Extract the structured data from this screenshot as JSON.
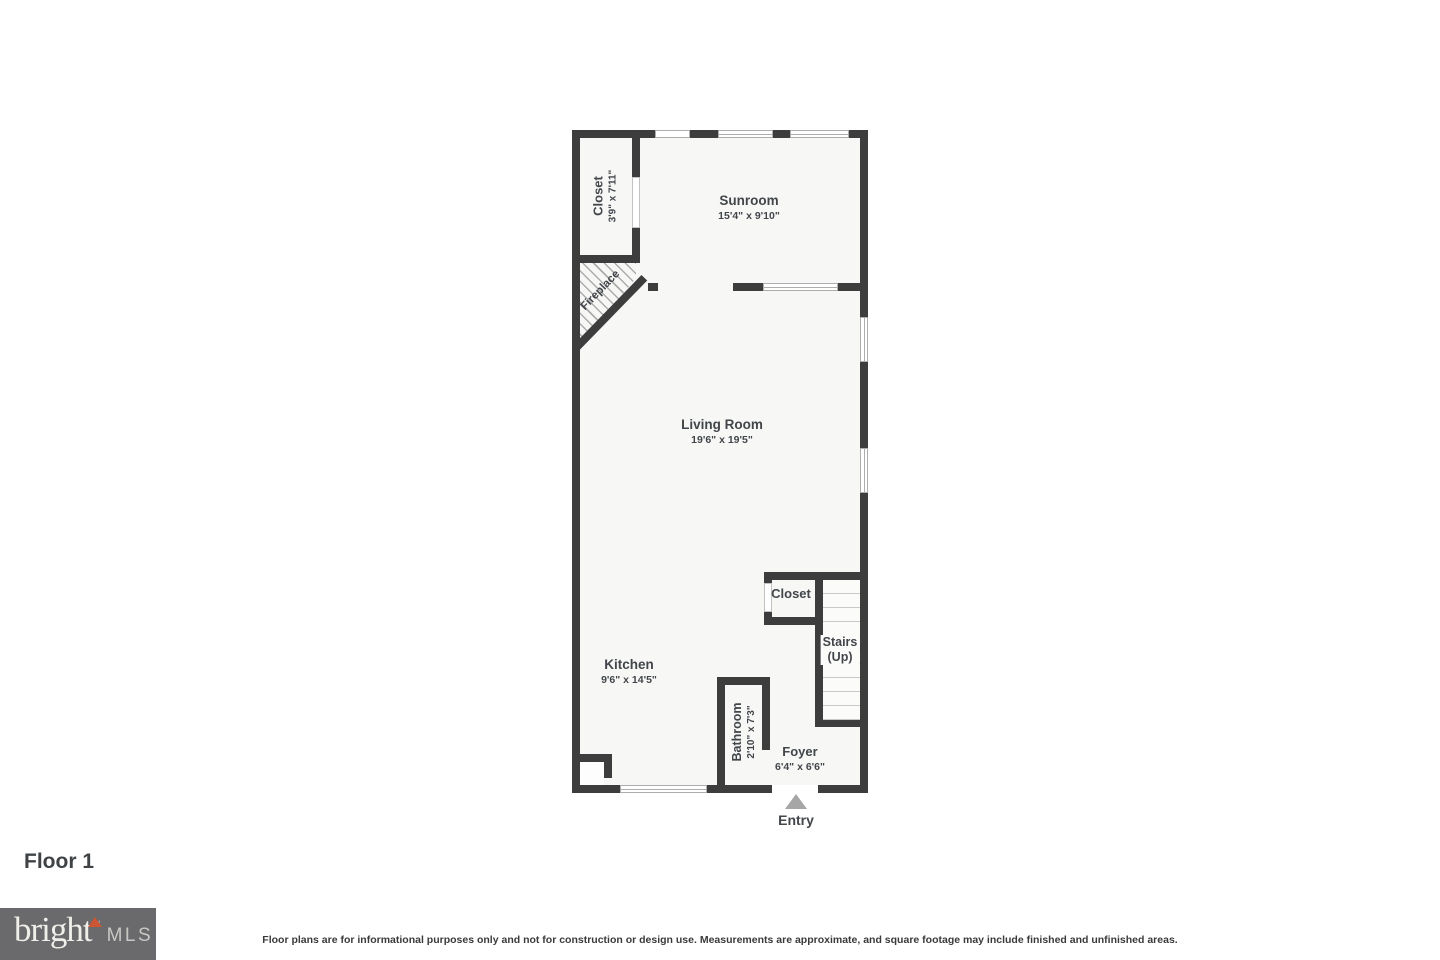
{
  "page": {
    "floor_label": "Floor 1",
    "disclaimer": "Floor plans are for informational purposes only and not for construction or design use. Measurements are approximate, and square footage may include finished and unfinished areas."
  },
  "brand": {
    "name": "bright",
    "tm": "™",
    "suffix": "MLS"
  },
  "entry": {
    "label": "Entry"
  },
  "rooms": {
    "closet_top_left": {
      "name": "Closet",
      "dims": "3'9\" x 7'11\""
    },
    "sunroom": {
      "name": "Sunroom",
      "dims": "15'4\" x 9'10\""
    },
    "fireplace": {
      "name": "Fireplace"
    },
    "living_room": {
      "name": "Living Room",
      "dims": "19'6\" x 19'5\""
    },
    "closet_middle": {
      "name": "Closet"
    },
    "stairs": {
      "name": "Stairs",
      "direction": "(Up)"
    },
    "kitchen": {
      "name": "Kitchen",
      "dims": "9'6\" x 14'5\""
    },
    "bathroom": {
      "name": "Bathroom",
      "dims": "2'10\" x 7'3\""
    },
    "foyer": {
      "name": "Foyer",
      "dims": "6'4\" x 6'6\""
    }
  },
  "colors": {
    "wall": "#3d3d3d",
    "floor": "#f7f7f6",
    "step_line": "#c9c9c9",
    "entry_arrow": "#a6a6a6",
    "logo_background": "#6a696c",
    "logo_accent": "#cc5633",
    "logo_text": "#efeee9",
    "logo_mls": "#c9c8c5",
    "label_text": "#42464a"
  }
}
